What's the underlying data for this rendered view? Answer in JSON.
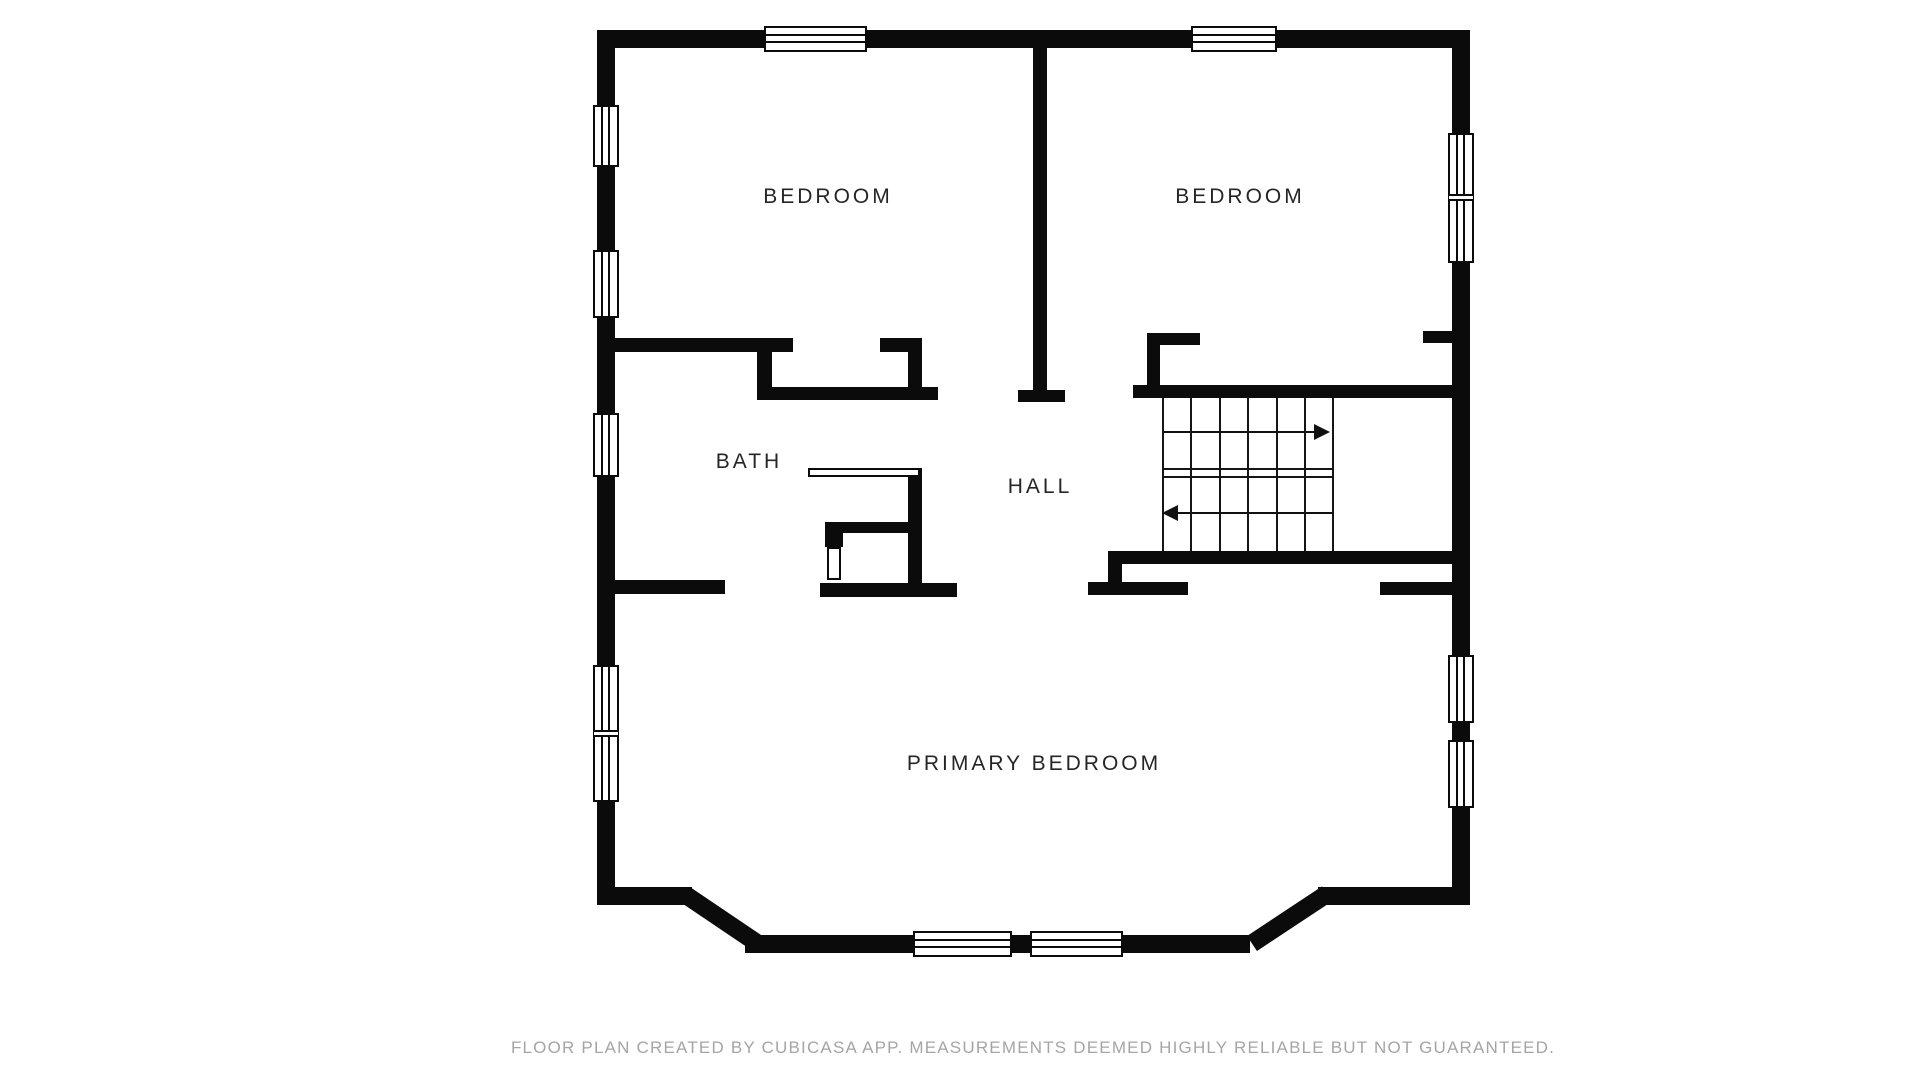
{
  "floor_plan": {
    "rooms": [
      {
        "id": "bedroom-1",
        "label": "BEDROOM"
      },
      {
        "id": "bedroom-2",
        "label": "BEDROOM"
      },
      {
        "id": "bath",
        "label": "BATH"
      },
      {
        "id": "hall",
        "label": "HALL"
      },
      {
        "id": "primary-bedroom",
        "label": "PRIMARY BEDROOM"
      }
    ],
    "stairs": {
      "up_arrow_direction": "right",
      "down_arrow_direction": "left",
      "tread_columns": 6
    },
    "colors": {
      "wall": "#0b0b0b",
      "room_fill": "#ffffff",
      "label_text": "#262626",
      "footer_text": "#a5a5a5"
    }
  },
  "footer": {
    "disclaimer": "FLOOR PLAN CREATED BY CUBICASA APP. MEASUREMENTS DEEMED HIGHLY RELIABLE BUT NOT GUARANTEED."
  }
}
